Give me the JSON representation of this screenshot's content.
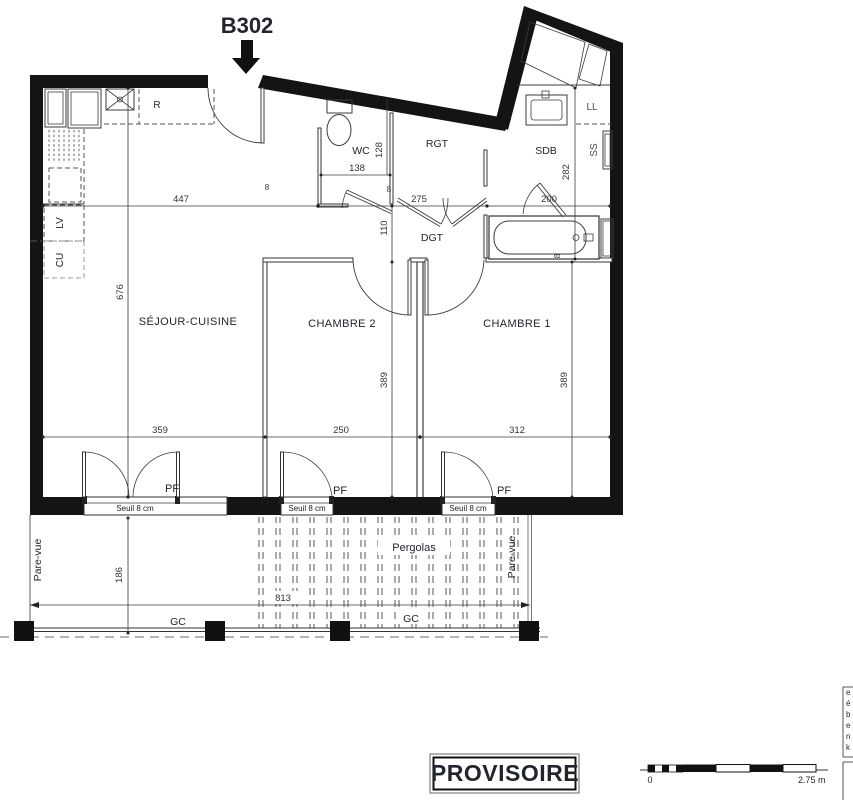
{
  "unit": {
    "label": "B302"
  },
  "rooms": {
    "sejour": "SÉJOUR-CUISINE",
    "chambre2": "CHAMBRE 2",
    "chambre1": "CHAMBRE 1",
    "wc": "WC",
    "rgt": "RGT",
    "sdb": "SDB",
    "dgt": "DGT"
  },
  "equipment": {
    "fridge": "R",
    "dishwasher": "LV",
    "hob": "CU",
    "washer": "LL",
    "towel_dryer": "SS"
  },
  "dims": {
    "sejour_w": "447",
    "hall_w": "275",
    "sdb_w": "200",
    "wc_w": "138",
    "wc_h": "128",
    "hall_h": "110",
    "sdb_h": "282",
    "sejour_h": "676",
    "ch2_h": "389",
    "ch1_h": "389",
    "pf_sejour": "359",
    "ch2_w": "250",
    "ch1_w": "312",
    "terrace_h": "186",
    "pergola_w": "813",
    "small_a": "8",
    "small_b": "8",
    "small_c": "8"
  },
  "openings": {
    "pf": "PF",
    "seuil": "Seuil 8 cm"
  },
  "outdoor": {
    "pergolas": "Pergolas",
    "pare_vue": "Pare-vue",
    "gc": "GC"
  },
  "stamp": {
    "provisoire": "PROVISOIRE"
  },
  "scale_bar": {
    "start": "0",
    "end": "2.75 m"
  },
  "notes": {
    "l1": "e",
    "l2": "é",
    "l3": "b",
    "l4": "e",
    "l5": "n",
    "l6": "k"
  },
  "colors": {
    "wall": "#141414",
    "line": "#3c3c3c",
    "muted": "#9aa2b0",
    "bg": "#ffffff"
  }
}
